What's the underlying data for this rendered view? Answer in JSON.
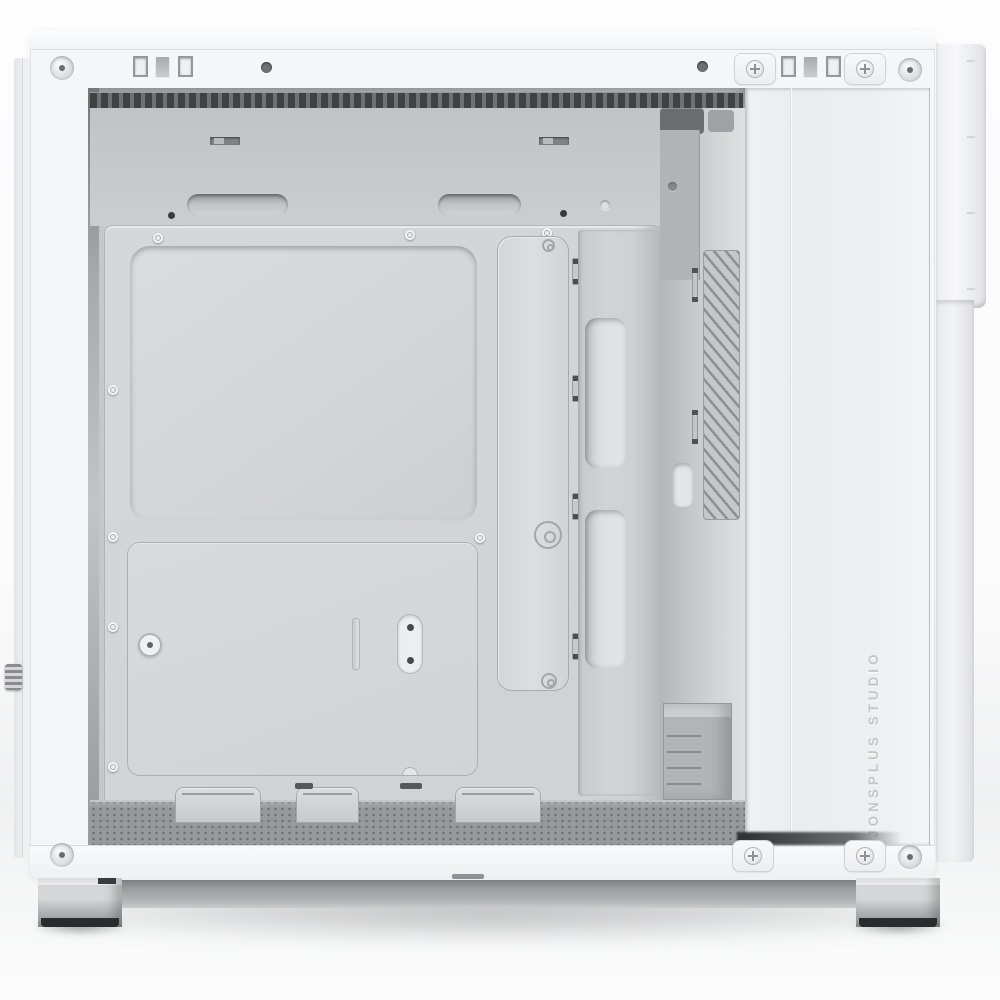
{
  "scene": {
    "subject": "White mid-tower PC case photographed from the open side, panel removed, empty interior",
    "branding": {
      "vertical_text": "JONSPLUS STUDIO"
    }
  },
  "palette": {
    "background": "#fbfbfc",
    "case_white": "#f5f6f8",
    "lip_white": "#fcfdfe",
    "column_white": "#eaecee",
    "upper_wall_gray": "#cdcfd2",
    "tray_gray": "#d5d7da",
    "cutout_gray": "#dadcdf",
    "channel_gray": "#c7c9cc",
    "vent_dark": "#3f4143",
    "wall_gray": "#b4b6b9",
    "floor_gray": "#96989b",
    "base_gray": "#9b9da0",
    "foot_silver": "#c9cbcd",
    "rubber_dark": "#2a2b2d",
    "edge_line": "#d8dade",
    "screw_dark": "#4a4c4e",
    "emboss_text": "#c3c6c9"
  },
  "structure": {
    "expansion_slot_count": 7,
    "standoff_count": 8,
    "cable_anchor_count": 4,
    "cable_passthrough_count": 2,
    "handle_cutout_count": 2,
    "top_latch_count": 2,
    "wall_slot_count": 2,
    "tray_tab_count": 3,
    "top_thumbscrew_tab_count": 2,
    "bottom_thumbscrew_tab_count": 2,
    "foot_count": 2
  }
}
